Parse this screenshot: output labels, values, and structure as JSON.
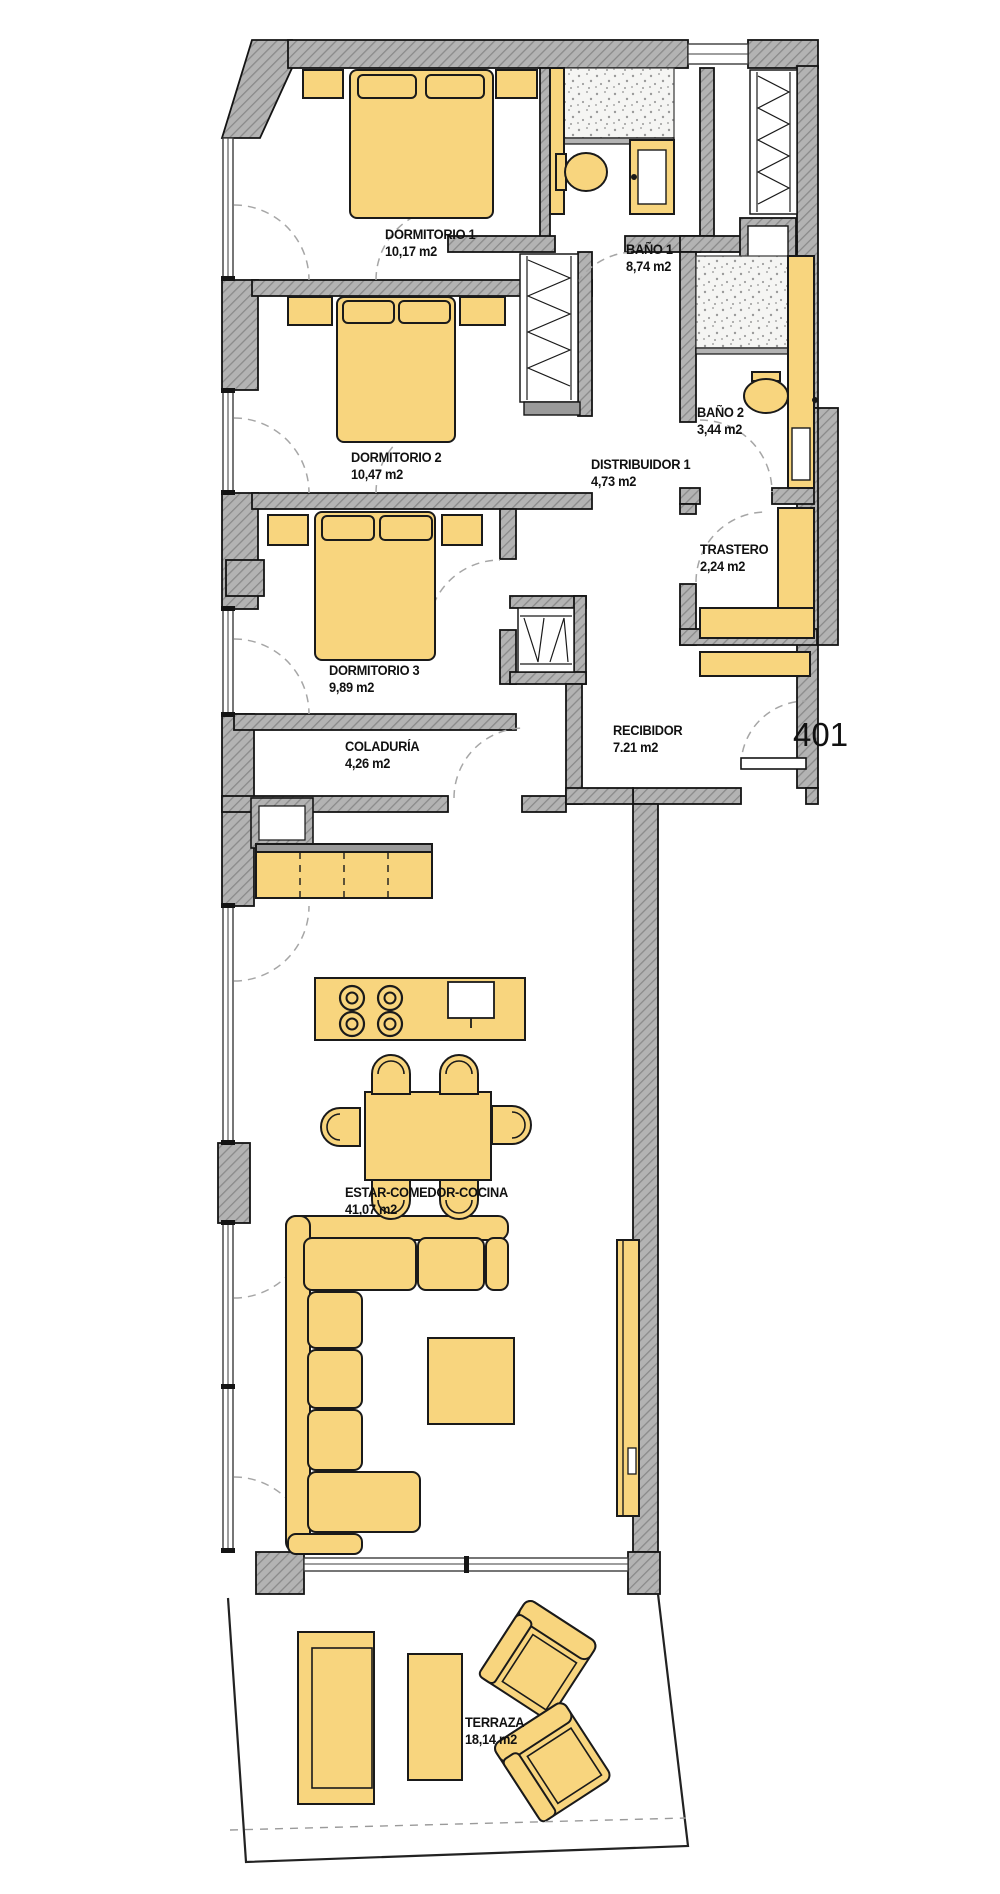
{
  "unit": {
    "number": "401"
  },
  "rooms": [
    {
      "name": "DORMITORIO 1",
      "area": "10,17 m2"
    },
    {
      "name": "BAÑO 1",
      "area": "8,74 m2"
    },
    {
      "name": "DORMITORIO 2",
      "area": "10,47 m2"
    },
    {
      "name": "BAÑO 2",
      "area": "3,44 m2"
    },
    {
      "name": "DISTRIBUIDOR 1",
      "area": "4,73 m2"
    },
    {
      "name": "TRASTERO",
      "area": "2,24 m2"
    },
    {
      "name": "DORMITORIO 3",
      "area": "9,89 m2"
    },
    {
      "name": "RECIBIDOR",
      "area": "7.21 m2"
    },
    {
      "name": "COLADURÍA",
      "area": "4,26 m2"
    },
    {
      "name": "ESTAR-COMEDOR-COCINA",
      "area": "41,07 m2"
    },
    {
      "name": "TERRAZA",
      "area": "18,14 m2"
    }
  ],
  "colors": {
    "furniture": "#F8D57E",
    "wall": "#B3B3B3",
    "outline": "#1A1A1A",
    "door_arc": "#A6A6A6"
  }
}
